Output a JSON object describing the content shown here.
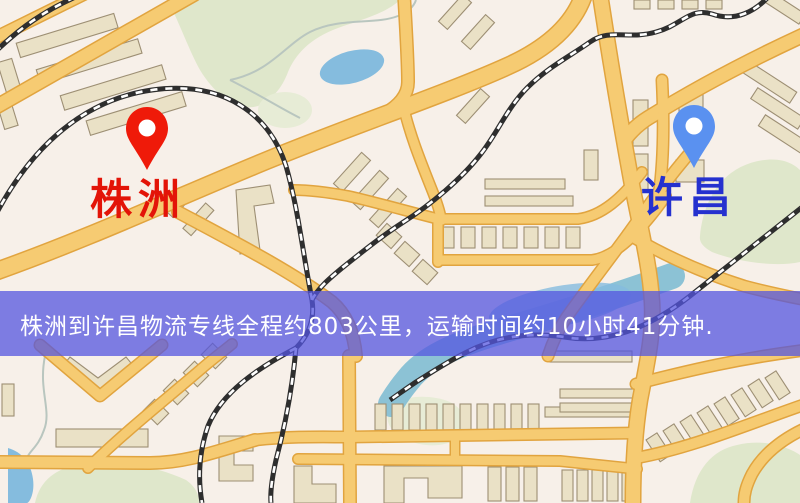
{
  "map": {
    "markers": [
      {
        "id": "origin",
        "label": "株洲",
        "pin_color": "#ef1a09",
        "label_color": "#e31408"
      },
      {
        "id": "destination",
        "label": "许昌",
        "pin_color": "#5a91f0",
        "label_color": "#2531cf"
      }
    ],
    "banner": {
      "text": "株洲到许昌物流专线全程约803公里，运输时间约10小时41分钟.",
      "background_color": "#5455df",
      "text_color": "#ffffff"
    },
    "route": {
      "origin": "株洲",
      "destination": "许昌",
      "distance_km": "803",
      "duration": "10小时41分钟"
    },
    "palette": {
      "land": "#f7f0e9",
      "road_fill": "#f6cb72",
      "road_casing": "#e1a43f",
      "building": "#eae1c6",
      "building_outline": "#9d8f74",
      "park": "#dfe7cb",
      "water": "#85bcde",
      "railway": "#2e2e2e"
    }
  }
}
